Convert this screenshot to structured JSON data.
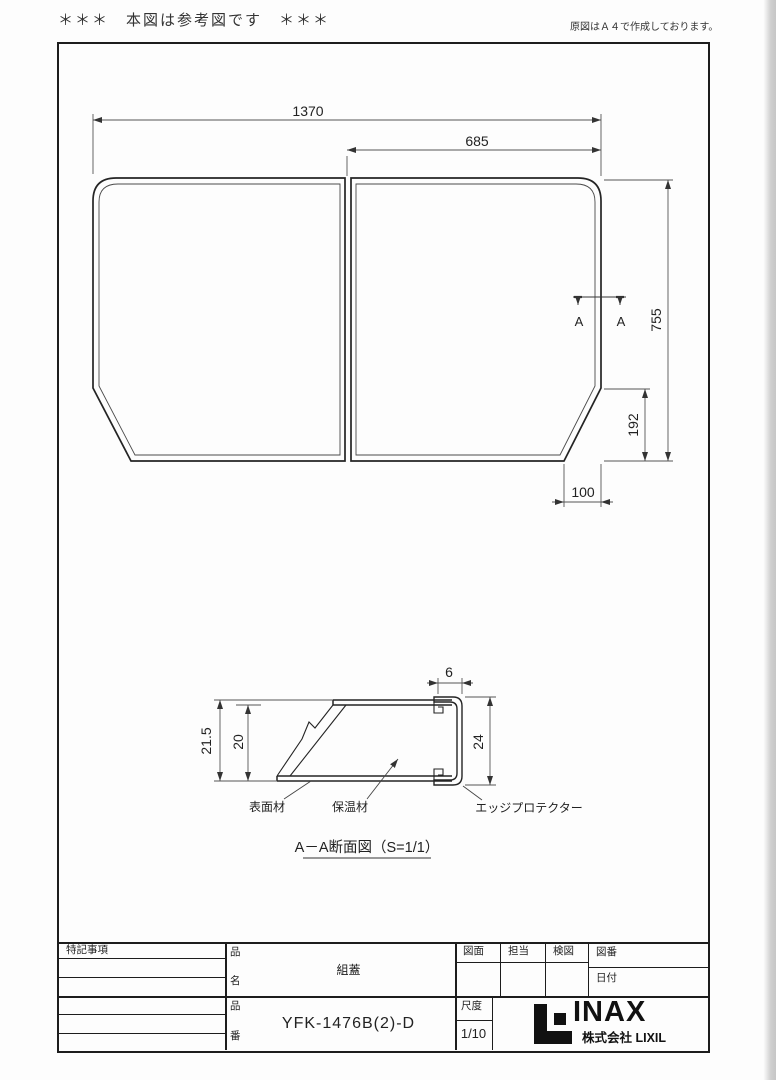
{
  "page": {
    "top_left_note": "＊＊＊　本図は参考図です　＊＊＊",
    "top_right_note": "原図はＡ４で作成しております。"
  },
  "plan_view": {
    "dim_width_total": "1370",
    "dim_width_half": "685",
    "dim_height_total": "755",
    "dim_chamfer_height": "192",
    "dim_chamfer_width": "100",
    "section_mark_left": "A",
    "section_mark_right": "A"
  },
  "section_view": {
    "dim_thickness_total": "21.5",
    "dim_thickness_core": "20",
    "dim_edge_width": "6",
    "dim_edge_height": "24",
    "label_surface_material": "表面材",
    "label_insulation_material": "保温材",
    "label_edge_protector": "エッジプロテクター",
    "caption": "A－A断面図（S=1/1）"
  },
  "title_block": {
    "notes_label": "特記事項",
    "product_name_label_top": "品",
    "product_name_label_bottom": "名",
    "product_name_value": "組蓋",
    "product_no_label_top": "品",
    "product_no_label_bottom": "番",
    "product_no_value": "YFK-1476B(2)-D",
    "drawing_label": "図面",
    "person_label": "担当",
    "check_label": "検図",
    "drawing_no_label": "図番",
    "date_label": "日付",
    "scale_label": "尺度",
    "scale_value": "1/10",
    "logo_text": "INAX",
    "logo_subtext": "株式会社 LIXIL"
  }
}
